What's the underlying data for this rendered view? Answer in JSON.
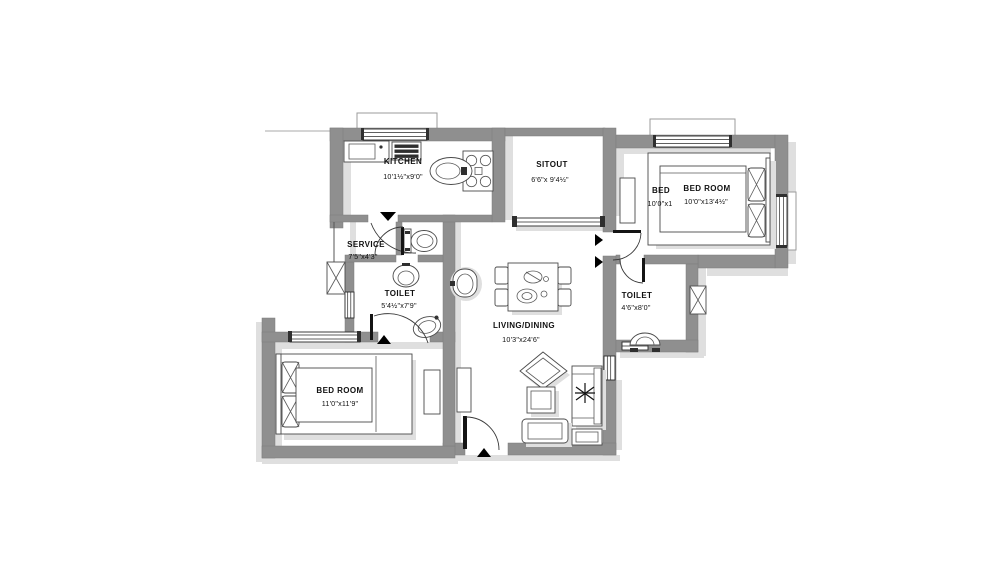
{
  "drawing": {
    "type": "architectural-floor-plan",
    "colors": {
      "wall": "#8f8f8f",
      "shadow": "#dfdfdf",
      "line": "#333333",
      "text": "#111111",
      "bg": "#ffffff"
    },
    "rooms": {
      "kitchen": {
        "label": "KITCHEN",
        "dims": "10'1½\"x9'0\""
      },
      "sitout": {
        "label": "SITOUT",
        "dims": "6'6\"x 9'4½\""
      },
      "bedroom_top": {
        "label": "BED ROOM",
        "dims": "10'0\"x13'4½\""
      },
      "bedroom_top_alt": {
        "label": "BED",
        "dims": "10'0\"x1"
      },
      "service": {
        "label": "SERVICE",
        "dims": "7'5\"x4'3\""
      },
      "toilet_left": {
        "label": "TOILET",
        "dims": "5'4½\"x7'9\""
      },
      "toilet_right": {
        "label": "TOILET",
        "dims": "4'6\"x8'0\""
      },
      "living_dining": {
        "label": "LIVING/DINING",
        "dims": "10'3\"x24'6\""
      },
      "bedroom_bottom": {
        "label": "BED ROOM",
        "dims": "11'0\"x11'9\""
      }
    }
  }
}
